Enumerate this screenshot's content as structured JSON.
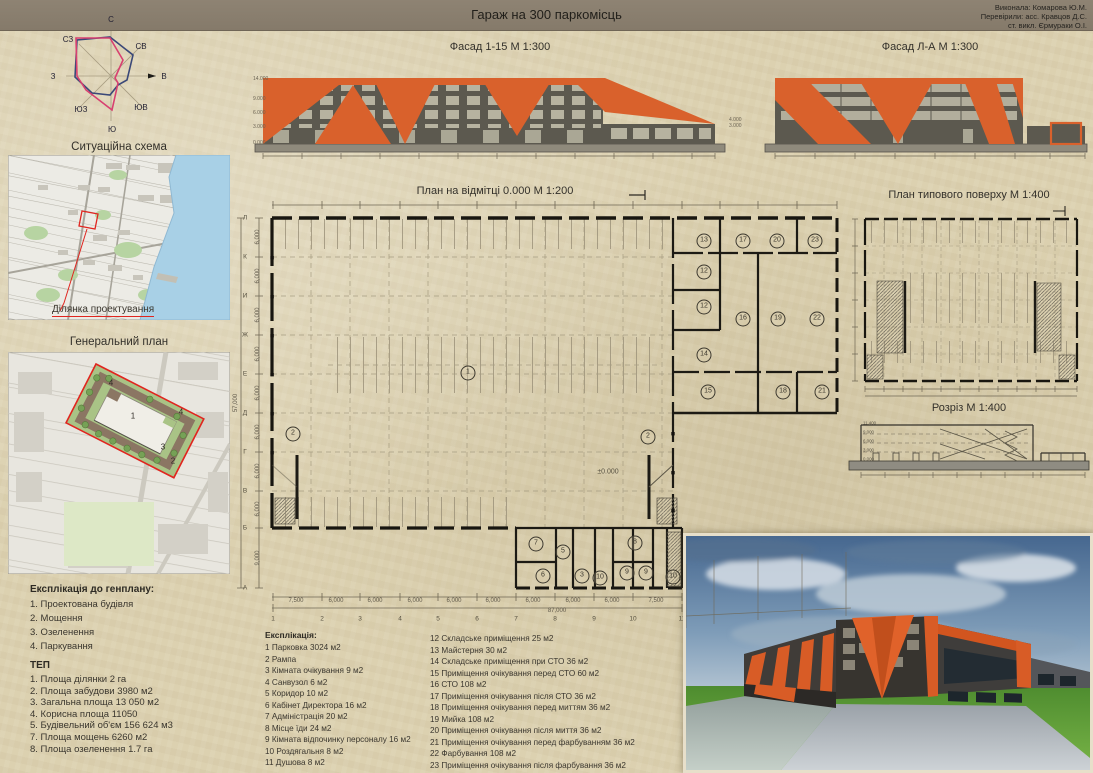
{
  "board": {
    "title": "Гараж на 300 паркомісць",
    "credits": [
      "Виконала: Комарова Ю.М.",
      "Перевірили: асс. Кравцов Д.С.",
      "ст. викл. Єрмураки О.І."
    ]
  },
  "colors": {
    "accent_orange": "#d9612c",
    "facade_gray": "#5c594f",
    "paper": "#dcd1b0",
    "windrose_blue": "#3a4878",
    "windrose_pink": "#d84070",
    "water_blue": "#a8d0e6",
    "site_red": "#e0251f"
  },
  "windrose": {
    "n": "С",
    "ne": "СВ",
    "e": "В",
    "se": "ЮВ",
    "s": "Ю",
    "sw": "ЮЗ",
    "w": "З",
    "nw": "СЗ"
  },
  "situation": {
    "title": "Ситуаційна схема",
    "site_label": "Ділянка проектування"
  },
  "genplan": {
    "title": "Генеральний план",
    "markers": [
      {
        "t": "4",
        "x": 103,
        "y": 31
      },
      {
        "t": "1",
        "x": 125,
        "y": 64
      },
      {
        "t": "4",
        "x": 173,
        "y": 60
      },
      {
        "t": "3",
        "x": 155,
        "y": 95
      },
      {
        "t": "2",
        "x": 165,
        "y": 109
      }
    ]
  },
  "exp_genplan": {
    "heading": "Експлікація до генплану:",
    "items": [
      "1. Проектована будівля",
      "2. Мощення",
      "3. Озеленення",
      "4. Паркування"
    ]
  },
  "tep": {
    "heading": "ТЕП",
    "items": [
      "1. Площа ділянки 2 га",
      "2. Площа забудови 3980 м2",
      "3. Загальна площа 13 050 м2",
      "4. Корисна площа 11050",
      "5. Будівельний об'єм 156 624 м3",
      "7. Площа мощень 6260 м2",
      "8. Площа озеленення 1.7 га"
    ]
  },
  "facade_1": {
    "title": "Фасад 1-15 М 1:300",
    "levels_left": [
      "14.000",
      "9.000",
      "6.000",
      "3.000",
      "0.000"
    ],
    "levels_right": [
      "4.000",
      "3.000"
    ]
  },
  "facade_2": {
    "title": "Фасад Л-А М 1:300"
  },
  "main_plan": {
    "title": "План на відмітці 0.000 М 1:200",
    "level_mark": "±0.000",
    "rooms": [
      {
        "n": "1",
        "x": 235,
        "y": 186
      },
      {
        "n": "2",
        "x": 60,
        "y": 247
      },
      {
        "n": "2",
        "x": 415,
        "y": 250
      },
      {
        "n": "13",
        "x": 471,
        "y": 54
      },
      {
        "n": "17",
        "x": 510,
        "y": 54
      },
      {
        "n": "20",
        "x": 544,
        "y": 54
      },
      {
        "n": "23",
        "x": 582,
        "y": 54
      },
      {
        "n": "12",
        "x": 471,
        "y": 85
      },
      {
        "n": "12",
        "x": 471,
        "y": 120
      },
      {
        "n": "16",
        "x": 510,
        "y": 132
      },
      {
        "n": "19",
        "x": 545,
        "y": 132
      },
      {
        "n": "22",
        "x": 584,
        "y": 132
      },
      {
        "n": "14",
        "x": 471,
        "y": 168
      },
      {
        "n": "15",
        "x": 475,
        "y": 205
      },
      {
        "n": "18",
        "x": 550,
        "y": 205
      },
      {
        "n": "21",
        "x": 589,
        "y": 205
      },
      {
        "n": "7",
        "x": 303,
        "y": 357
      },
      {
        "n": "5",
        "x": 330,
        "y": 365
      },
      {
        "n": "6",
        "x": 310,
        "y": 389
      },
      {
        "n": "3",
        "x": 349,
        "y": 389
      },
      {
        "n": "10",
        "x": 367,
        "y": 391
      },
      {
        "n": "8",
        "x": 402,
        "y": 356
      },
      {
        "n": "9",
        "x": 394,
        "y": 386
      },
      {
        "n": "9",
        "x": 413,
        "y": 386
      },
      {
        "n": "10",
        "x": 440,
        "y": 390
      }
    ],
    "row_letters": [
      {
        "t": "Л",
        "x": 12,
        "y": 31
      },
      {
        "t": "К",
        "x": 12,
        "y": 70
      },
      {
        "t": "И",
        "x": 12,
        "y": 109
      },
      {
        "t": "Ж",
        "x": 12,
        "y": 148
      },
      {
        "t": "Е",
        "x": 12,
        "y": 187
      },
      {
        "t": "Д",
        "x": 12,
        "y": 226
      },
      {
        "t": "Г",
        "x": 12,
        "y": 265
      },
      {
        "t": "В",
        "x": 12,
        "y": 304
      },
      {
        "t": "Б",
        "x": 12,
        "y": 341
      },
      {
        "t": "А",
        "x": 12,
        "y": 401
      }
    ],
    "side_dims": [
      {
        "t": "6,000",
        "x": 25,
        "y": 50
      },
      {
        "t": "6,000",
        "x": 25,
        "y": 89
      },
      {
        "t": "6,000",
        "x": 25,
        "y": 128
      },
      {
        "t": "6,000",
        "x": 25,
        "y": 167
      },
      {
        "t": "6,000",
        "x": 25,
        "y": 206
      },
      {
        "t": "6,000",
        "x": 25,
        "y": 245
      },
      {
        "t": "6,000",
        "x": 25,
        "y": 284
      },
      {
        "t": "6,000",
        "x": 25,
        "y": 322
      },
      {
        "t": "9,000",
        "x": 25,
        "y": 371
      }
    ],
    "side_total": {
      "t": "57,000"
    },
    "bottom_dims": [
      {
        "t": "7,500",
        "x": 63,
        "y": 414
      },
      {
        "t": "6,000",
        "x": 103,
        "y": 414
      },
      {
        "t": "6,000",
        "x": 142,
        "y": 414
      },
      {
        "t": "6,000",
        "x": 182,
        "y": 414
      },
      {
        "t": "6,000",
        "x": 221,
        "y": 414
      },
      {
        "t": "6,000",
        "x": 260,
        "y": 414
      },
      {
        "t": "6,000",
        "x": 300,
        "y": 414
      },
      {
        "t": "6,000",
        "x": 340,
        "y": 414
      },
      {
        "t": "6,000",
        "x": 379,
        "y": 414
      },
      {
        "t": "7,500",
        "x": 423,
        "y": 414
      }
    ],
    "bottom_total": {
      "t": "87,000"
    },
    "col_numbers": [
      {
        "t": "1",
        "x": 40,
        "y": 432
      },
      {
        "t": "2",
        "x": 89,
        "y": 432
      },
      {
        "t": "3",
        "x": 127,
        "y": 432
      },
      {
        "t": "4",
        "x": 167,
        "y": 432
      },
      {
        "t": "5",
        "x": 205,
        "y": 432
      },
      {
        "t": "6",
        "x": 244,
        "y": 432
      },
      {
        "t": "7",
        "x": 283,
        "y": 432
      },
      {
        "t": "8",
        "x": 322,
        "y": 432
      },
      {
        "t": "9",
        "x": 361,
        "y": 432
      },
      {
        "t": "10",
        "x": 400,
        "y": 432
      },
      {
        "t": "11",
        "x": 449,
        "y": 432
      }
    ]
  },
  "typical_plan": {
    "title": "План типового поверху М 1:400"
  },
  "section": {
    "title": "Розріз М 1:400",
    "levels": [
      "0.000",
      "3.000",
      "6.000",
      "9.000",
      "11.400"
    ]
  },
  "explication": {
    "heading": "Експлікація:",
    "col1": [
      "1 Парковка 3024 м2",
      "2 Рампа",
      "3 Кімната очікування 9 м2",
      "4 Санвузол 6 м2",
      "5 Коридор 10 м2",
      "6 Кабінет Директора 16 м2",
      "7 Адміністрація 20 м2",
      "8 Місце їди 24 м2",
      "9 Кімната відпочинку персоналу 16 м2",
      "10 Роздягальня 8 м2",
      "11 Душова 8 м2"
    ],
    "col2": [
      "12 Складське приміщення 25 м2",
      "13 Майстерня 30 м2",
      "14 Складське приміщення при СТО 36 м2",
      "15 Приміщення очікування перед СТО 60 м2",
      "16 СТО 108 м2",
      "17 Приміщення очікування після СТО 36 м2",
      "18 Приміщення очікування перед миттям 36 м2",
      "19 Мийка 108 м2",
      "20 Приміщення очікування після миття 36 м2",
      "21 Приміщення очікування перед фарбуванням 36 м2",
      "22 Фарбування 108 м2",
      "23 Приміщення очікування після фарбування 36 м2"
    ]
  }
}
